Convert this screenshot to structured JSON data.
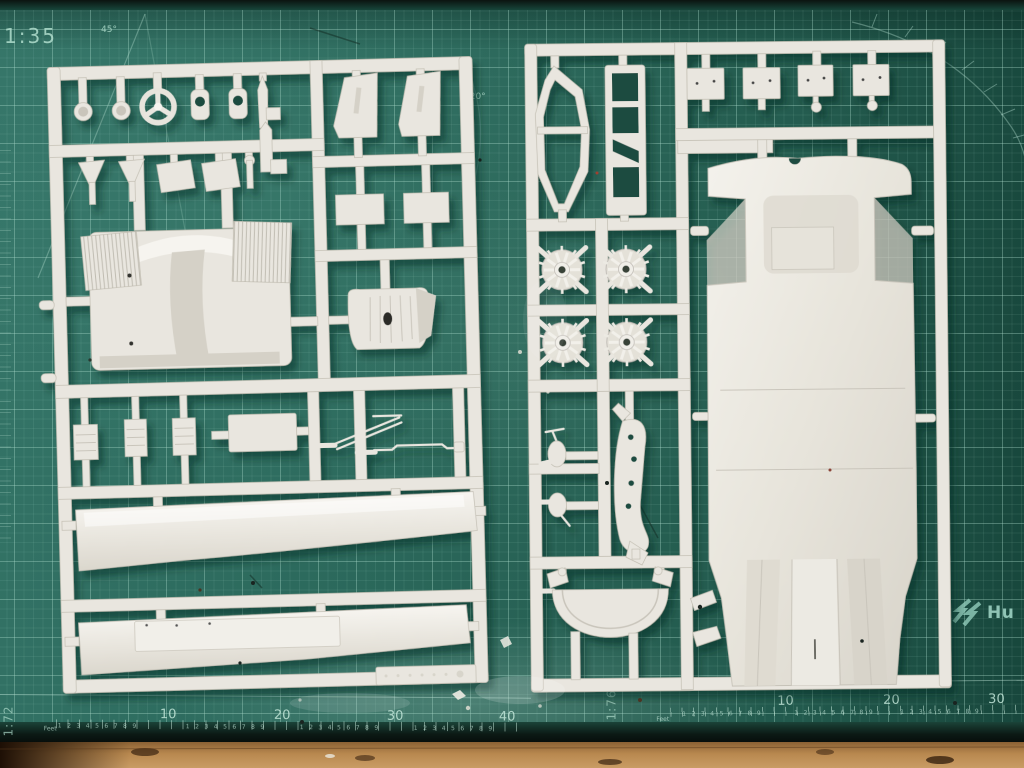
{
  "mat": {
    "top_scale_label": "1:35",
    "angle_label_45": "45°",
    "angle_label_120": "120°",
    "brand": {
      "icon": "humbrol-zigzag-icon",
      "text_partial": "Hu"
    },
    "left_ruler": {
      "scale_label": "1:72",
      "unit_label": "Feet",
      "numbers": [
        "10",
        "20",
        "30",
        "40"
      ],
      "minor_digits": "1 2 3 4 5 6 7 8 9"
    },
    "right_ruler": {
      "scale_label": "1:76",
      "unit_label": "Feet",
      "numbers": [
        "10",
        "20",
        "30"
      ],
      "minor_digits": "1 2 3 4 5 6 7 8 9"
    },
    "colors": {
      "mat_green": "#2b695c",
      "mat_green_dark": "#1d5347",
      "grid_line": "#a7d6c9",
      "printed_text": "#9fd0c3"
    }
  },
  "sprues": {
    "colors": {
      "plastic": "#e9e6df",
      "plastic_shadow": "#c2beb2",
      "plastic_highlight": "#f6f4ef"
    }
  },
  "table": {
    "colors": {
      "wood": "#b8884f",
      "mat_edge": "#101c17"
    }
  }
}
